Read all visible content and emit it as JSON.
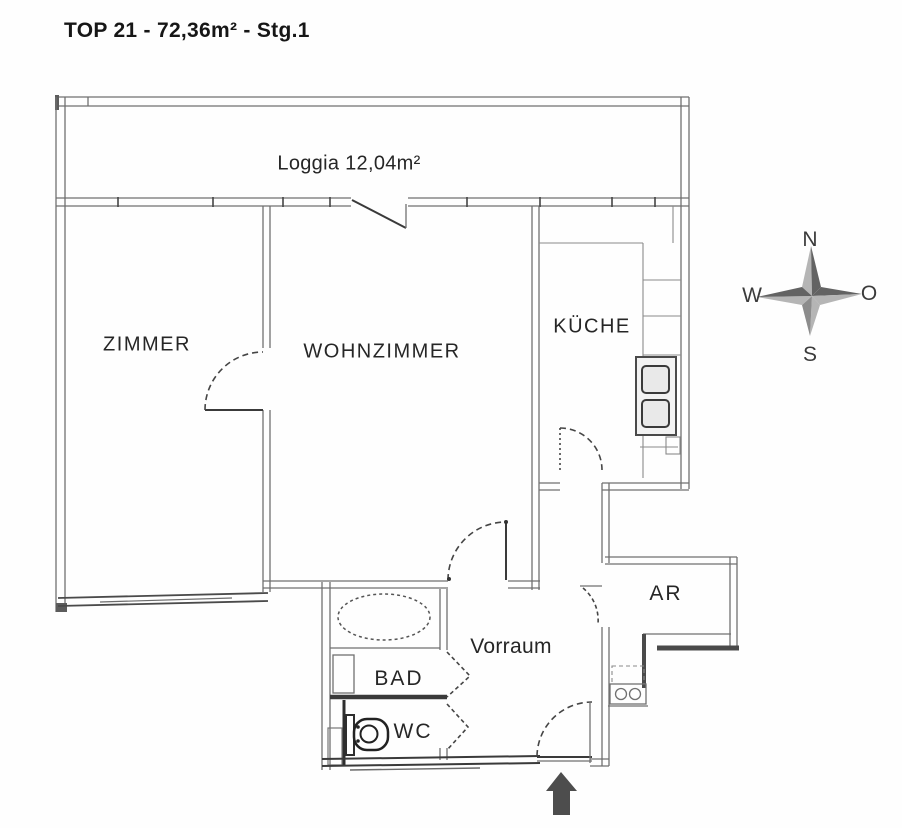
{
  "title": "TOP 21 - 72,36m² - Stg.1",
  "rooms": {
    "loggia": {
      "label": "Loggia 12,04m²"
    },
    "zimmer": {
      "label": "ZIMMER"
    },
    "wohnzimmer": {
      "label": "WOHNZIMMER"
    },
    "kueche": {
      "label": "KÜCHE"
    },
    "bad": {
      "label": "BAD"
    },
    "wc": {
      "label": "WC"
    },
    "vorraum": {
      "label": "Vorraum"
    },
    "ar": {
      "label": "AR"
    }
  },
  "compass": {
    "north": "N",
    "east": "O",
    "south": "S",
    "west": "W"
  },
  "colors": {
    "background": "#fefefe",
    "wall_line": "#707070",
    "dark_line": "#3a3a3a",
    "text": "#262626",
    "compass_dark": "#636363",
    "compass_light": "#b5b5b5",
    "entrance_arrow": "#4d4d4d"
  }
}
